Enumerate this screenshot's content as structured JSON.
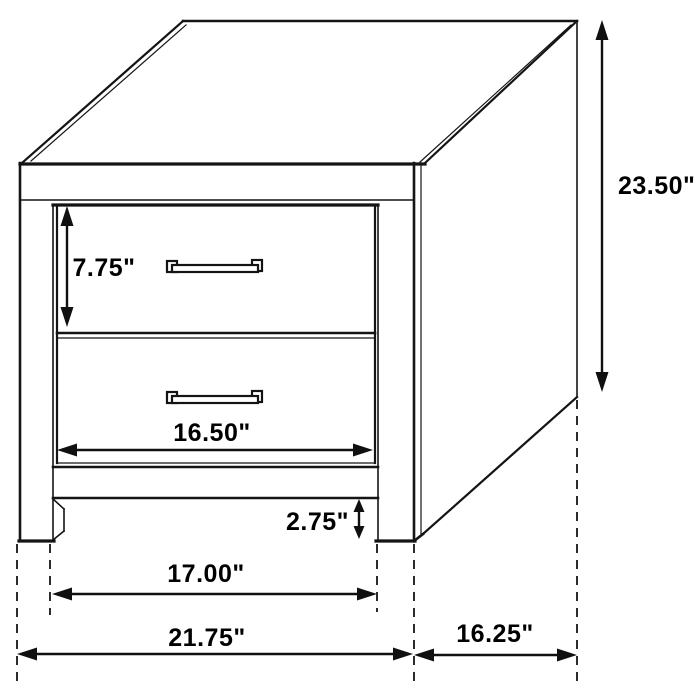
{
  "diagram": {
    "subject": "two-drawer-nightstand-dimension-drawing",
    "background_color": "#ffffff",
    "line_color": "#141414",
    "drawer_count": 2,
    "dimensions": {
      "overall_height": "23.50\"",
      "drawer_face_height": "7.75\"",
      "drawer_opening_width": "16.50\"",
      "foot_clearance": "2.75\"",
      "between_legs_width": "17.00\"",
      "overall_width": "21.75\"",
      "side_depth": "16.25\""
    }
  }
}
